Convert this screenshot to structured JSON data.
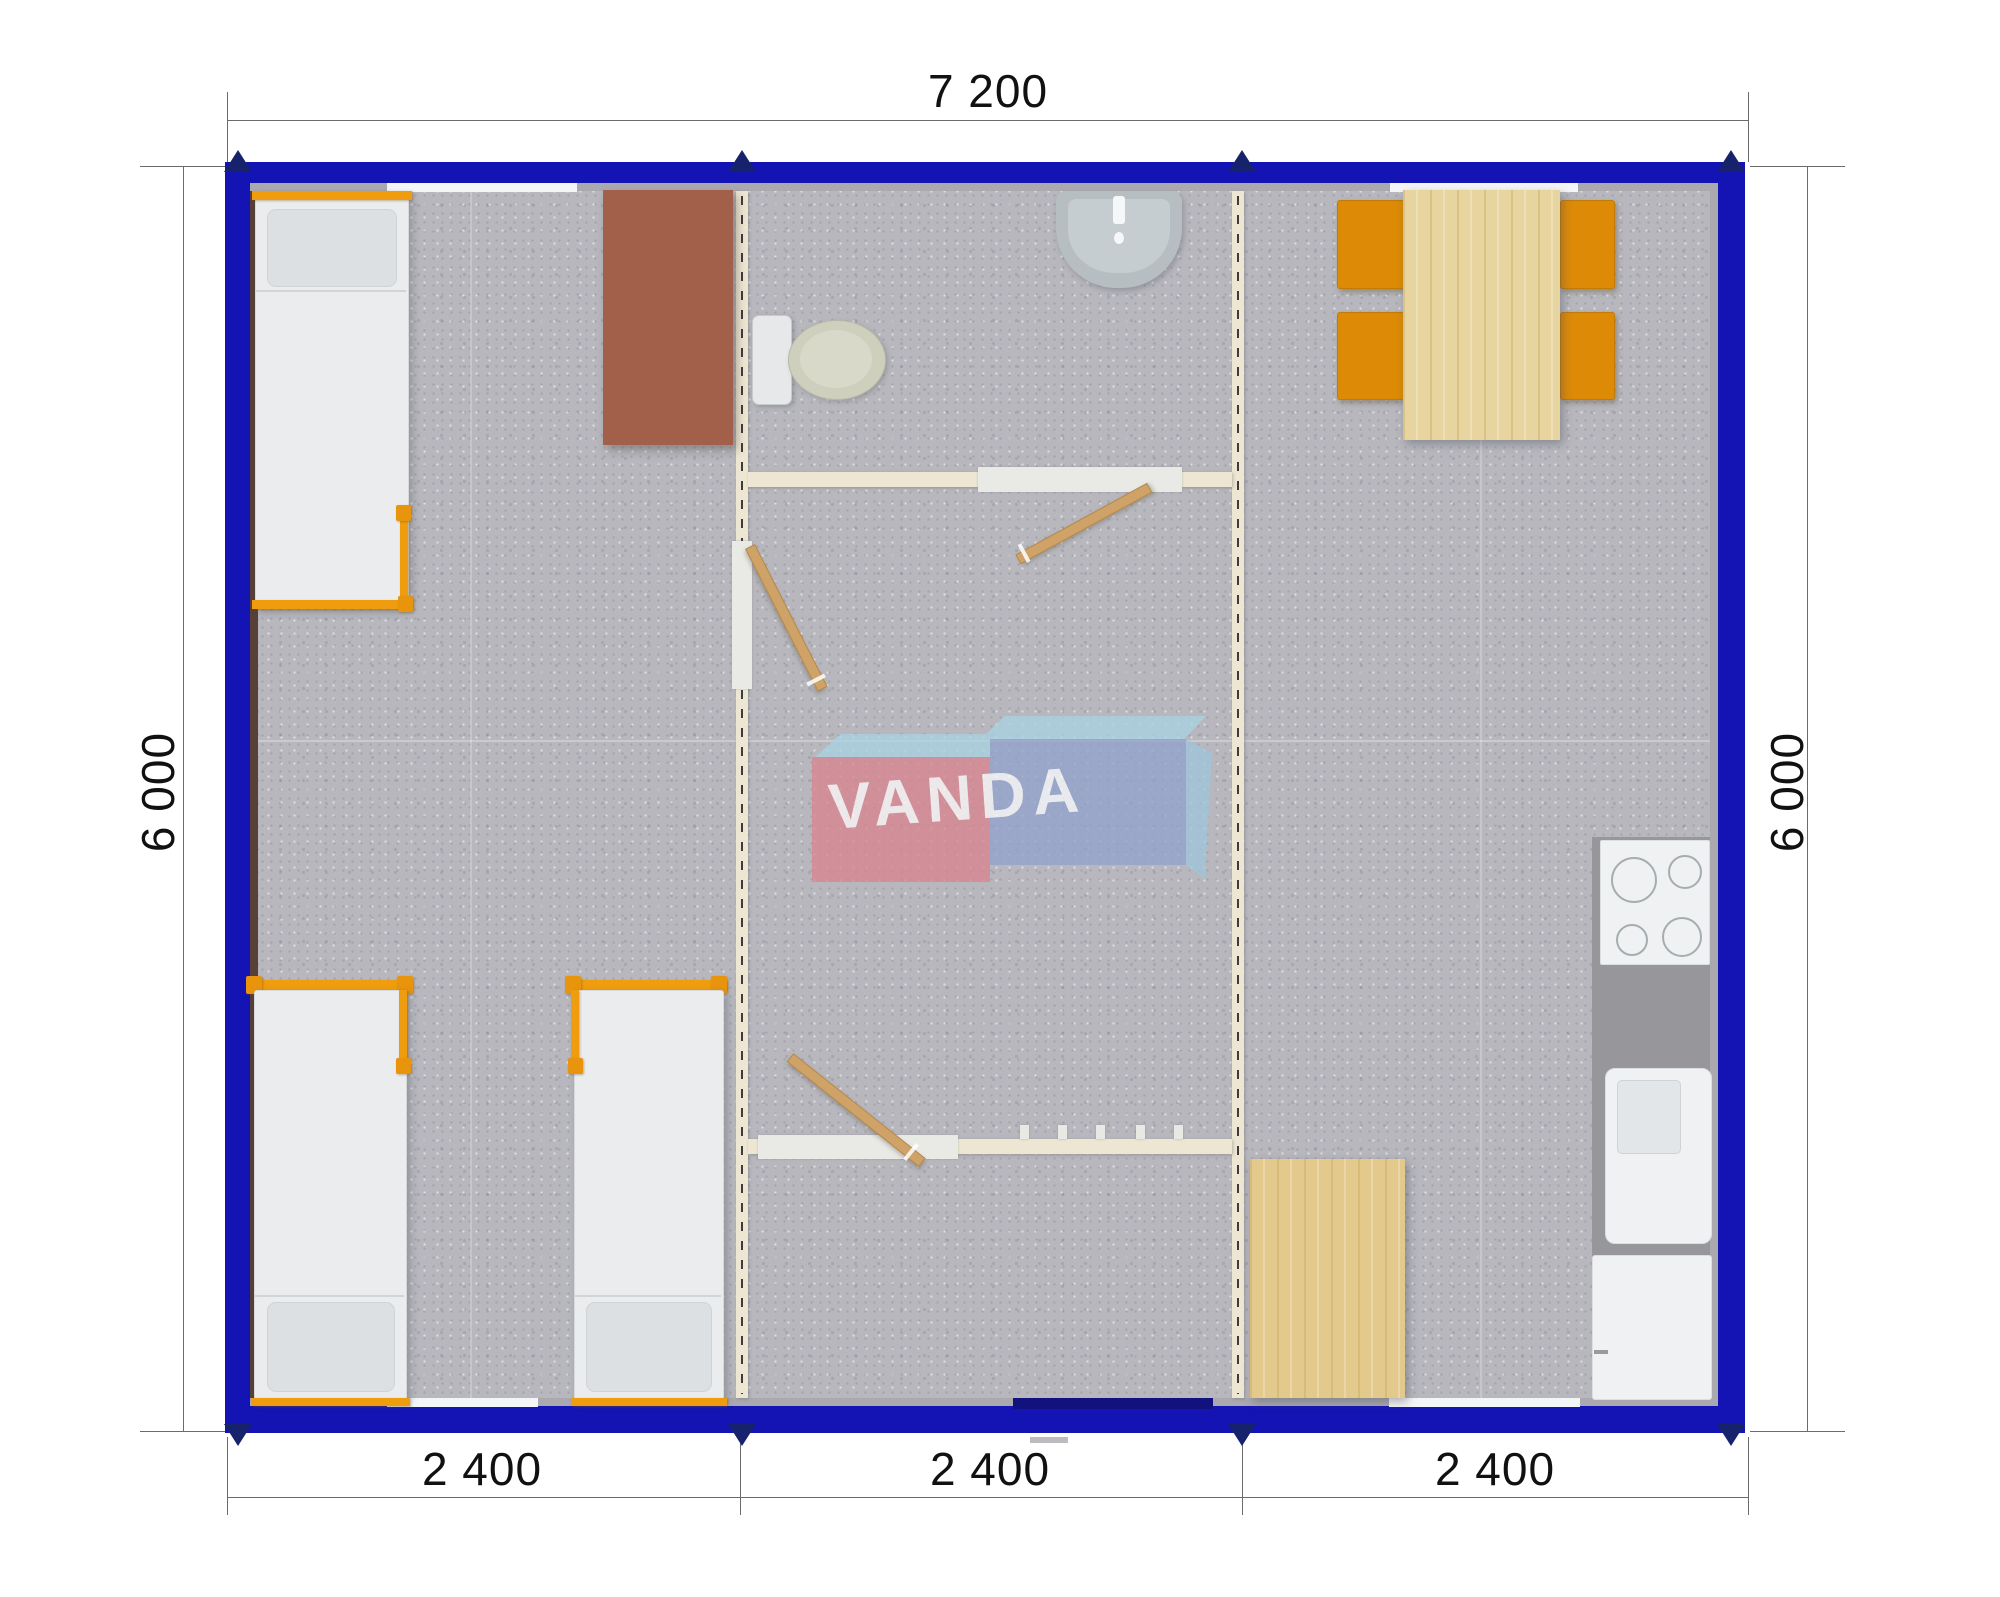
{
  "dimensions": {
    "top": "7 200",
    "left": "6 000",
    "right": "6 000",
    "bottom": [
      "2 400",
      "2 400",
      "2 400"
    ]
  },
  "watermark": {
    "text": "VANDA"
  },
  "colors": {
    "wall_blue": "#1414b4",
    "module_marker_navy": "#16226b",
    "partition_cream": "#ece6d2",
    "floor_gray": "#b7b7bd",
    "furniture_orange": "#ef9d0e",
    "chair_orange": "#dd8b07",
    "wood_light": "#e7d49e",
    "desk_brown": "#a2604a",
    "counter_gray": "#97979b",
    "entrance_navy": "#12127e",
    "logo_red": "#d9868f",
    "logo_blue": "#93a3cc",
    "logo_light_blue": "#a9d3e2",
    "dimension_text": "#111111"
  }
}
